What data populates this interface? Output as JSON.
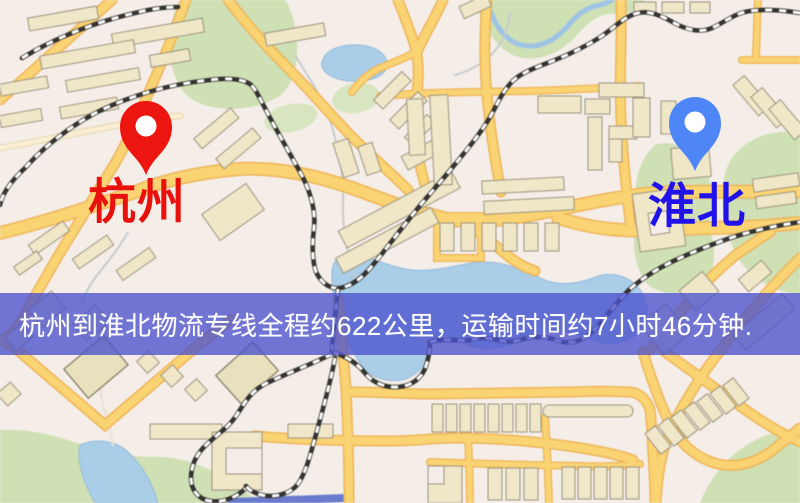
{
  "map": {
    "origin_marker": {
      "label": "杭州",
      "pin_color": "#ED1510",
      "label_color": "#E8110D"
    },
    "destination_marker": {
      "label": "淮北",
      "pin_color": "#4F86F7",
      "label_color": "#2012E8"
    }
  },
  "banner": {
    "text": "杭州到淮北物流专线全程约622公里，运输时间约7小时46分钟.",
    "route": {
      "origin": "杭州",
      "destination": "淮北",
      "service": "物流专线",
      "distance": "约622公里",
      "duration": "约7小时46分钟"
    },
    "bg_color": "rgba(76,82,204,0.78)",
    "text_color": "#FFFFFF"
  },
  "palette": {
    "map_background": "#F5EEE8",
    "road_fill": "#F9D376",
    "road_casing": "#ECB45C",
    "railway_dark": "#34332F",
    "railway_light": "#FFFFFF",
    "building_fill": "#F0E7CA",
    "building_stroke": "#9B927E",
    "park_green": "#CFE0B6",
    "water_blue": "#ABCEE6"
  }
}
